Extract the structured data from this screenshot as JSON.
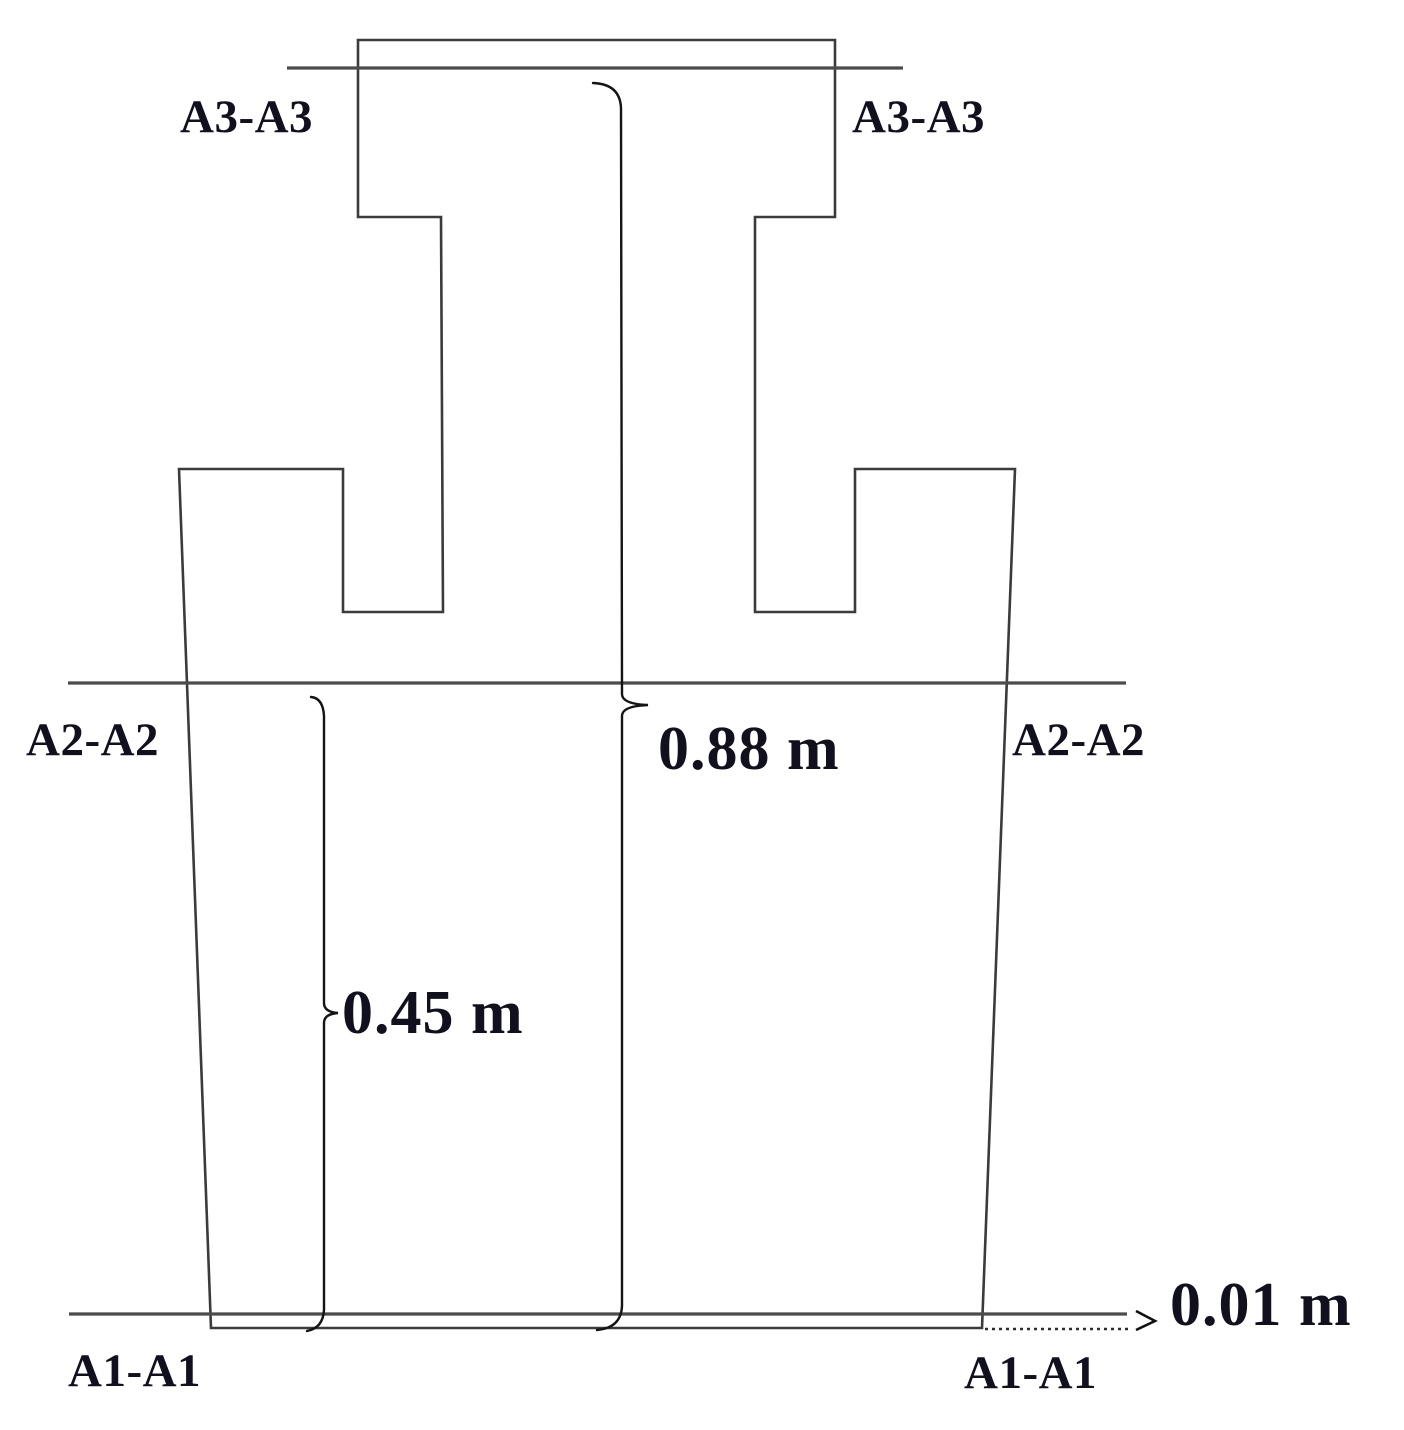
{
  "diagram": {
    "title": "pier elevation with section cut lines",
    "section_labels": {
      "a3_left": "A3-A3",
      "a3_right": "A3-A3",
      "a2_left": "A2-A2",
      "a2_right": "A2-A2",
      "a1_left": "A1-A1",
      "a1_right": "A1-A1"
    },
    "dimensions": {
      "total_height": "0.88 m",
      "lower_height": "0.45 m",
      "bottom_offset": "0.01 m"
    },
    "colors": {
      "background": "#ffffff",
      "outline": "#3b3b3b",
      "section_line": "#4c4c4c",
      "brace": "#141414",
      "text": "#10101e"
    }
  }
}
